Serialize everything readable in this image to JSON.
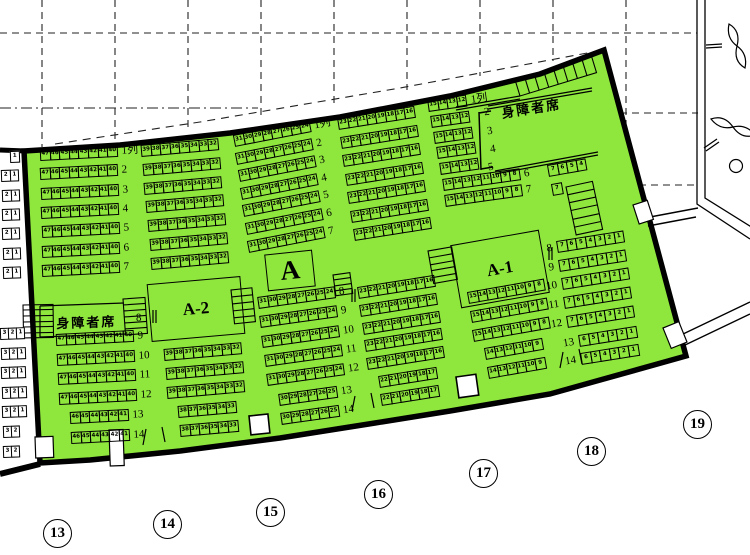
{
  "map": {
    "highlight_color": "#8FE63D",
    "labels": {
      "section": "A",
      "sub_left": "A-2",
      "sub_right": "A-1",
      "disabled": "身障者席",
      "row_unit": "列"
    },
    "gates": [
      {
        "n": "13",
        "x": 57,
        "y": 533
      },
      {
        "n": "14",
        "x": 167,
        "y": 524
      },
      {
        "n": "15",
        "x": 270,
        "y": 512
      },
      {
        "n": "16",
        "x": 378,
        "y": 494
      },
      {
        "n": "17",
        "x": 483,
        "y": 473
      },
      {
        "n": "18",
        "x": 591,
        "y": 451
      },
      {
        "n": "19",
        "x": 697,
        "y": 424
      }
    ],
    "floating_labels": [
      {
        "t": "8",
        "x": 136,
        "y": 312,
        "a": -3
      },
      {
        "t": "2",
        "x": 484,
        "y": 106,
        "a": -8
      },
      {
        "t": "3",
        "x": 487,
        "y": 125,
        "a": -8
      },
      {
        "t": "4",
        "x": 490,
        "y": 143,
        "a": -8
      },
      {
        "t": "5",
        "x": 488,
        "y": 161,
        "a": -8
      }
    ],
    "patterns": {
      "s47_40": [
        "47",
        "46",
        "45",
        "44",
        "43",
        "42",
        "41",
        "40"
      ],
      "s46_41": [
        "46",
        "45",
        "44",
        "43",
        "42",
        "41"
      ],
      "s39_32": [
        "39",
        "38",
        "37",
        "36",
        "35",
        "34",
        "33",
        "32"
      ],
      "s38_33": [
        "38",
        "37",
        "36",
        "35",
        "34",
        "33"
      ],
      "s31_24": [
        "31",
        "30",
        "29",
        "28",
        "27",
        "26",
        "25",
        "24"
      ],
      "s30_25": [
        "30",
        "29",
        "28",
        "27",
        "26",
        "25"
      ],
      "s23_16": [
        "23",
        "22",
        "21",
        "20",
        "19",
        "18",
        "17",
        "16"
      ],
      "s22_17": [
        "22",
        "21",
        "20",
        "19",
        "18",
        "17"
      ],
      "s15_12": [
        "15",
        "14",
        "13",
        "12"
      ],
      "s15_8": [
        "15",
        "14",
        "13",
        "12",
        "11",
        "10",
        "9",
        "8"
      ],
      "s14_9": [
        "14",
        "13",
        "12",
        "11",
        "10",
        "9"
      ],
      "s7_1": [
        "7",
        "6",
        "5",
        "4",
        "3",
        "2",
        "1"
      ],
      "s6_1": [
        "6",
        "5",
        "4",
        "3",
        "2",
        "1"
      ],
      "s7_4": [
        "7",
        "6",
        "5",
        "4"
      ],
      "s7": [
        "7"
      ],
      "s1": [
        "1"
      ],
      "s2_1": [
        "2",
        "1"
      ],
      "s3_2_1": [
        "3",
        "2",
        "1"
      ],
      "s3_2": [
        "3",
        "2"
      ]
    },
    "blocks": [
      {
        "id": "upper-47-40",
        "x": 40,
        "y": 149,
        "a": -3,
        "dy": 19.3,
        "dx": 0.4,
        "side": "right",
        "rows": [
          {
            "l": "1列",
            "p": "s47_40"
          },
          {
            "l": "2",
            "p": "s47_40"
          },
          {
            "l": "3",
            "p": "s47_40"
          },
          {
            "l": "4",
            "p": "s47_40"
          },
          {
            "l": "5",
            "p": "s47_40"
          },
          {
            "l": "6",
            "p": "s47_40"
          },
          {
            "l": "7",
            "p": "s47_40"
          }
        ]
      },
      {
        "id": "upper-39-32",
        "x": 141,
        "y": 145,
        "a": -5,
        "dy": 18.8,
        "dx": 1.7,
        "rows": [
          {
            "p": "s39_32"
          },
          {
            "p": "s39_32"
          },
          {
            "p": "s39_32"
          },
          {
            "p": "s39_32"
          },
          {
            "p": "s39_32"
          },
          {
            "p": "s39_32"
          },
          {
            "p": "s39_32"
          }
        ]
      },
      {
        "id": "upper-31-24",
        "x": 234,
        "y": 135,
        "a": -11,
        "dy": 17.6,
        "dx": 2.3,
        "side": "right",
        "rows": [
          {
            "l": "1列",
            "p": "s31_24"
          },
          {
            "l": "2",
            "p": "s31_24"
          },
          {
            "l": "3",
            "p": "s31_24"
          },
          {
            "l": "4",
            "p": "s31_24"
          },
          {
            "l": "5",
            "p": "s31_24"
          },
          {
            "l": "6",
            "p": "s31_24"
          },
          {
            "l": "7",
            "p": "s31_24"
          }
        ]
      },
      {
        "id": "upper-23-16",
        "x": 338,
        "y": 118,
        "a": -9,
        "dy": 18.5,
        "dx": 2.6,
        "rows": [
          {
            "p": "s23_16"
          },
          {
            "p": "s23_16"
          },
          {
            "p": "s23_16"
          },
          {
            "p": "s23_16"
          },
          {
            "p": "s23_16"
          },
          {
            "p": "s23_16"
          },
          {
            "p": "s23_16"
          }
        ]
      },
      {
        "id": "upper-15-12",
        "x": 428,
        "y": 100,
        "a": -8,
        "dy": 15.8,
        "dx": 2.9,
        "side": "right",
        "rows": [
          {
            "l": "1列",
            "p": "s15_12"
          },
          {
            "p": "s15_12"
          },
          {
            "p": "s15_12"
          },
          {
            "p": "s15_12"
          },
          {
            "p": "s15_12"
          },
          {
            "l": "6",
            "p": "s15_8"
          },
          {
            "l": "7",
            "p": "s15_8"
          }
        ]
      },
      {
        "id": "upper-7-4",
        "x": 548,
        "y": 165,
        "a": -10,
        "dy": 19,
        "dx": 3.5,
        "rows": [
          {
            "p": "s7_4"
          },
          {
            "p": "s7"
          }
        ]
      },
      {
        "id": "lower-47-40",
        "x": 56,
        "y": 334,
        "a": -3,
        "dy": 19.5,
        "dx": 1.1,
        "side": "right",
        "rows": [
          {
            "l": "9",
            "p": "s47_40"
          },
          {
            "l": "10",
            "p": "s47_40"
          },
          {
            "l": "11",
            "p": "s47_40"
          },
          {
            "l": "12",
            "p": "s47_40"
          },
          {
            "l": "13",
            "p": "s46_41",
            "i": 1
          },
          {
            "l": "14",
            "p": "s46_41",
            "i": 1
          }
        ]
      },
      {
        "id": "lower-39-32",
        "x": 164,
        "y": 349,
        "a": -5,
        "dy": 19,
        "dx": 1.6,
        "rows": [
          {
            "p": "s39_32"
          },
          {
            "p": "s39_32"
          },
          {
            "p": "s39_32"
          },
          {
            "p": "s38_33",
            "i": 1
          },
          {
            "p": "s38_33",
            "i": 1
          }
        ]
      },
      {
        "id": "lower-31-24",
        "x": 258,
        "y": 297,
        "a": -8,
        "dy": 19.3,
        "dx": 2.2,
        "side": "right",
        "rows": [
          {
            "l": "8",
            "p": "s31_24"
          },
          {
            "l": "9",
            "p": "s31_24"
          },
          {
            "l": "10",
            "p": "s31_24"
          },
          {
            "l": "11",
            "p": "s31_24"
          },
          {
            "l": "12",
            "p": "s31_24"
          },
          {
            "l": "13",
            "p": "s30_25",
            "i": 1
          },
          {
            "l": "14",
            "p": "s30_25",
            "i": 1
          }
        ]
      },
      {
        "id": "lower-23-16",
        "x": 358,
        "y": 287,
        "a": -9,
        "dy": 17.8,
        "dx": 2.3,
        "rows": [
          {
            "p": "s23_16"
          },
          {
            "p": "s23_16"
          },
          {
            "p": "s23_16"
          },
          {
            "p": "s23_16"
          },
          {
            "p": "s23_16"
          },
          {
            "p": "s22_17",
            "i": 1
          },
          {
            "p": "s22_17",
            "i": 1
          }
        ]
      },
      {
        "id": "lower-15-8",
        "x": 468,
        "y": 292,
        "a": -10,
        "dy": 18.8,
        "dx": 2.5,
        "rows": [
          {
            "p": "s15_8"
          },
          {
            "p": "s15_8"
          },
          {
            "p": "s15_8"
          },
          {
            "p": "s14_9",
            "i": 1
          },
          {
            "p": "s14_9",
            "i": 1
          }
        ]
      },
      {
        "id": "lower-7-1",
        "x": 557,
        "y": 241,
        "a": -9,
        "dy": 18.7,
        "dx": 2.4,
        "side": "left",
        "rows": [
          {
            "l": "8",
            "p": "s7_1"
          },
          {
            "l": "9",
            "p": "s7_1"
          },
          {
            "l": "10",
            "p": "s7_1"
          },
          {
            "l": "11",
            "p": "s7_1"
          },
          {
            "l": "12",
            "p": "s7_1"
          },
          {
            "l": "13",
            "p": "s6_1",
            "i": 1
          },
          {
            "l": "14",
            "p": "s6_1",
            "i": 1
          }
        ]
      },
      {
        "id": "adjacent-upper",
        "x": 1,
        "y": 151,
        "a": -2,
        "dy": 19.3,
        "dx": 0.3,
        "cw": 9.6,
        "white": true,
        "rows": [
          {
            "p": "s1",
            "i": 1
          },
          {
            "p": "s2_1"
          },
          {
            "p": "s2_1"
          },
          {
            "p": "s2_1"
          },
          {
            "p": "s2_1"
          },
          {
            "p": "s2_1"
          },
          {
            "p": "s2_1"
          }
        ]
      },
      {
        "id": "adjacent-lower",
        "x": 0,
        "y": 328,
        "a": -2,
        "dy": 19.6,
        "dx": 0.5,
        "cw": 9,
        "white": true,
        "rows": [
          {
            "p": "s3_2_1"
          },
          {
            "p": "s3_2_1"
          },
          {
            "p": "s3_2_1"
          },
          {
            "p": "s3_2_1"
          },
          {
            "p": "s3_2_1"
          },
          {
            "p": "s3_2"
          },
          {
            "p": "s3_2"
          }
        ]
      }
    ]
  }
}
